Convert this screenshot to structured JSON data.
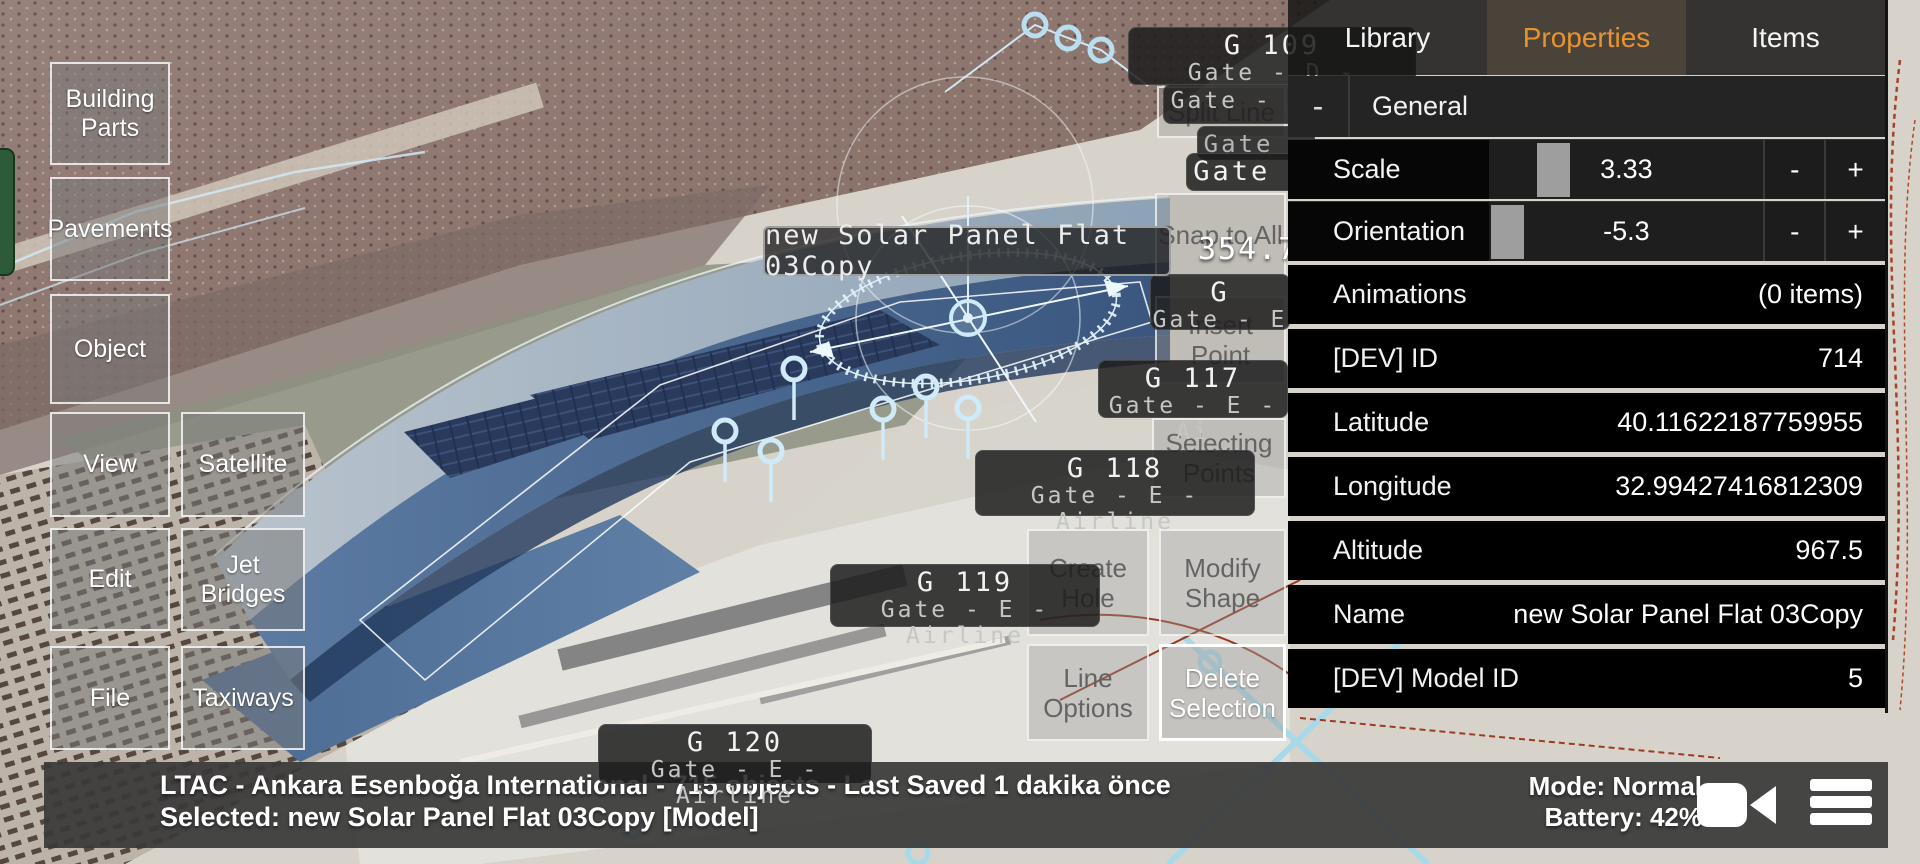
{
  "viewport": {
    "selection_label": "new Solar Panel Flat 03Copy",
    "measurement_readout": "354.7",
    "gate_labels": [
      {
        "line1": "G 109",
        "line2": "Gate - D - Airline"
      },
      {
        "line1": "Gate - D",
        "line2": ""
      },
      {
        "line1": "Gate -",
        "line2": ""
      },
      {
        "line1": "Gate -",
        "line2": ""
      },
      {
        "line1": "G",
        "line2": "Gate - E"
      },
      {
        "line1": "G 117",
        "line2": "Gate - E - Ai"
      },
      {
        "line1": "G 118",
        "line2": "Gate - E - Airline"
      },
      {
        "line1": "G 119",
        "line2": "Gate - E - Airline"
      },
      {
        "line1": "G 120",
        "line2": "Gate - E - Airline"
      }
    ]
  },
  "sidebar": {
    "items": [
      {
        "label": "Building Parts"
      },
      {
        "label": "Pavements"
      },
      {
        "label": "Object"
      },
      {
        "label": "View"
      },
      {
        "label": "Satellite"
      },
      {
        "label": "Edit"
      },
      {
        "label": "Jet Bridges"
      },
      {
        "label": "File"
      },
      {
        "label": "Taxiways"
      }
    ]
  },
  "edit_tools": {
    "buttons": [
      {
        "label": "Split Line",
        "enabled": false
      },
      {
        "label": "Snap to All",
        "enabled": false
      },
      {
        "label": "Insert Point",
        "enabled": false
      },
      {
        "label": "Selecting Points",
        "enabled": false
      },
      {
        "label": "Create Hole",
        "enabled": false
      },
      {
        "label": "Modify Shape",
        "enabled": false
      },
      {
        "label": "Line Options",
        "enabled": false
      },
      {
        "label": "Delete Selection",
        "enabled": true
      }
    ]
  },
  "properties_panel": {
    "tabs": [
      {
        "label": "Library",
        "active": false
      },
      {
        "label": "Properties",
        "active": true
      },
      {
        "label": "Items",
        "active": false
      }
    ],
    "section": {
      "collapse_label": "-",
      "title": "General"
    },
    "sliders": [
      {
        "label": "Scale",
        "value": "3.33",
        "decrement": "-",
        "increment": "+"
      },
      {
        "label": "Orientation",
        "value": "-5.3",
        "decrement": "-",
        "increment": "+"
      }
    ],
    "rows": [
      {
        "label": "Animations",
        "value": "(0 items)"
      },
      {
        "label": "[DEV] ID",
        "value": "714"
      },
      {
        "label": "Latitude",
        "value": "40.11622187759955"
      },
      {
        "label": "Longitude",
        "value": "32.99427416812309"
      },
      {
        "label": "Altitude",
        "value": "967.5"
      },
      {
        "label": "Name",
        "value": "new Solar Panel Flat 03Copy"
      },
      {
        "label": "[DEV] Model ID",
        "value": "5"
      }
    ]
  },
  "status_bar": {
    "line1": "LTAC - Ankara Esenboğa International - 715 objects - Last Saved 1 dakika önce",
    "line2": "Selected: new Solar Panel Flat 03Copy [Model]",
    "mode": "Mode: Normal",
    "battery": "Battery: 42%",
    "icons": {
      "camera": "video-camera",
      "menu": "hamburger-menu"
    }
  },
  "colors": {
    "accent": "#e8932f",
    "gizmo_blue": "#cfeaf8",
    "cyan_path": "#a8d9e8",
    "green_handle": "#2d5a39",
    "panel_black": "#000000"
  }
}
